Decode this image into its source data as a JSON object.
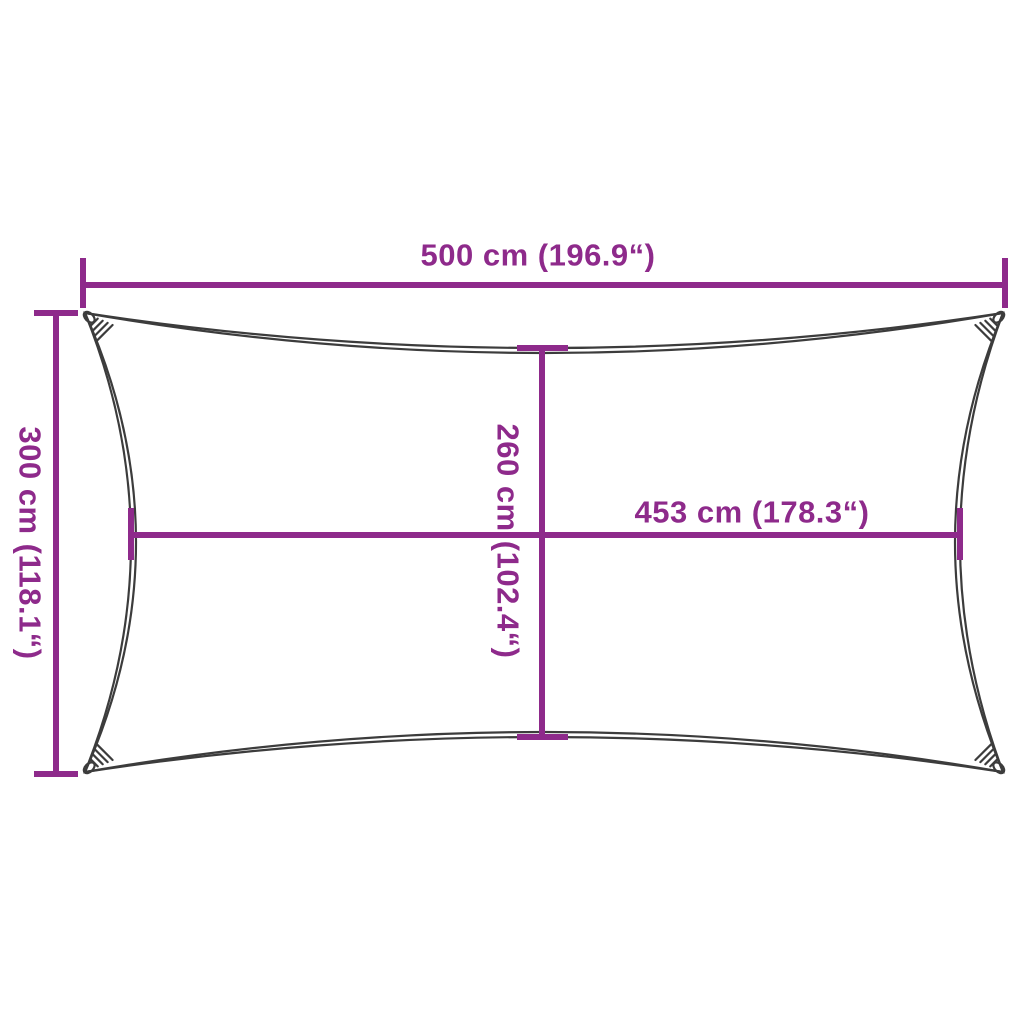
{
  "diagram": {
    "kind": "product-dimension-diagram",
    "subject": "rectangular shade sail outline with concave edges and corner loops",
    "labels": {
      "width_top": "500 cm (196.9“)",
      "height_left": "300 cm (118.1“)",
      "height_center": "260 cm (102.4“)",
      "width_center_right": "453 cm (178.3“)"
    },
    "colors": {
      "measurement": "#8E2A8B",
      "outline": "#3C3C3C",
      "background": "#FFFFFF"
    }
  }
}
